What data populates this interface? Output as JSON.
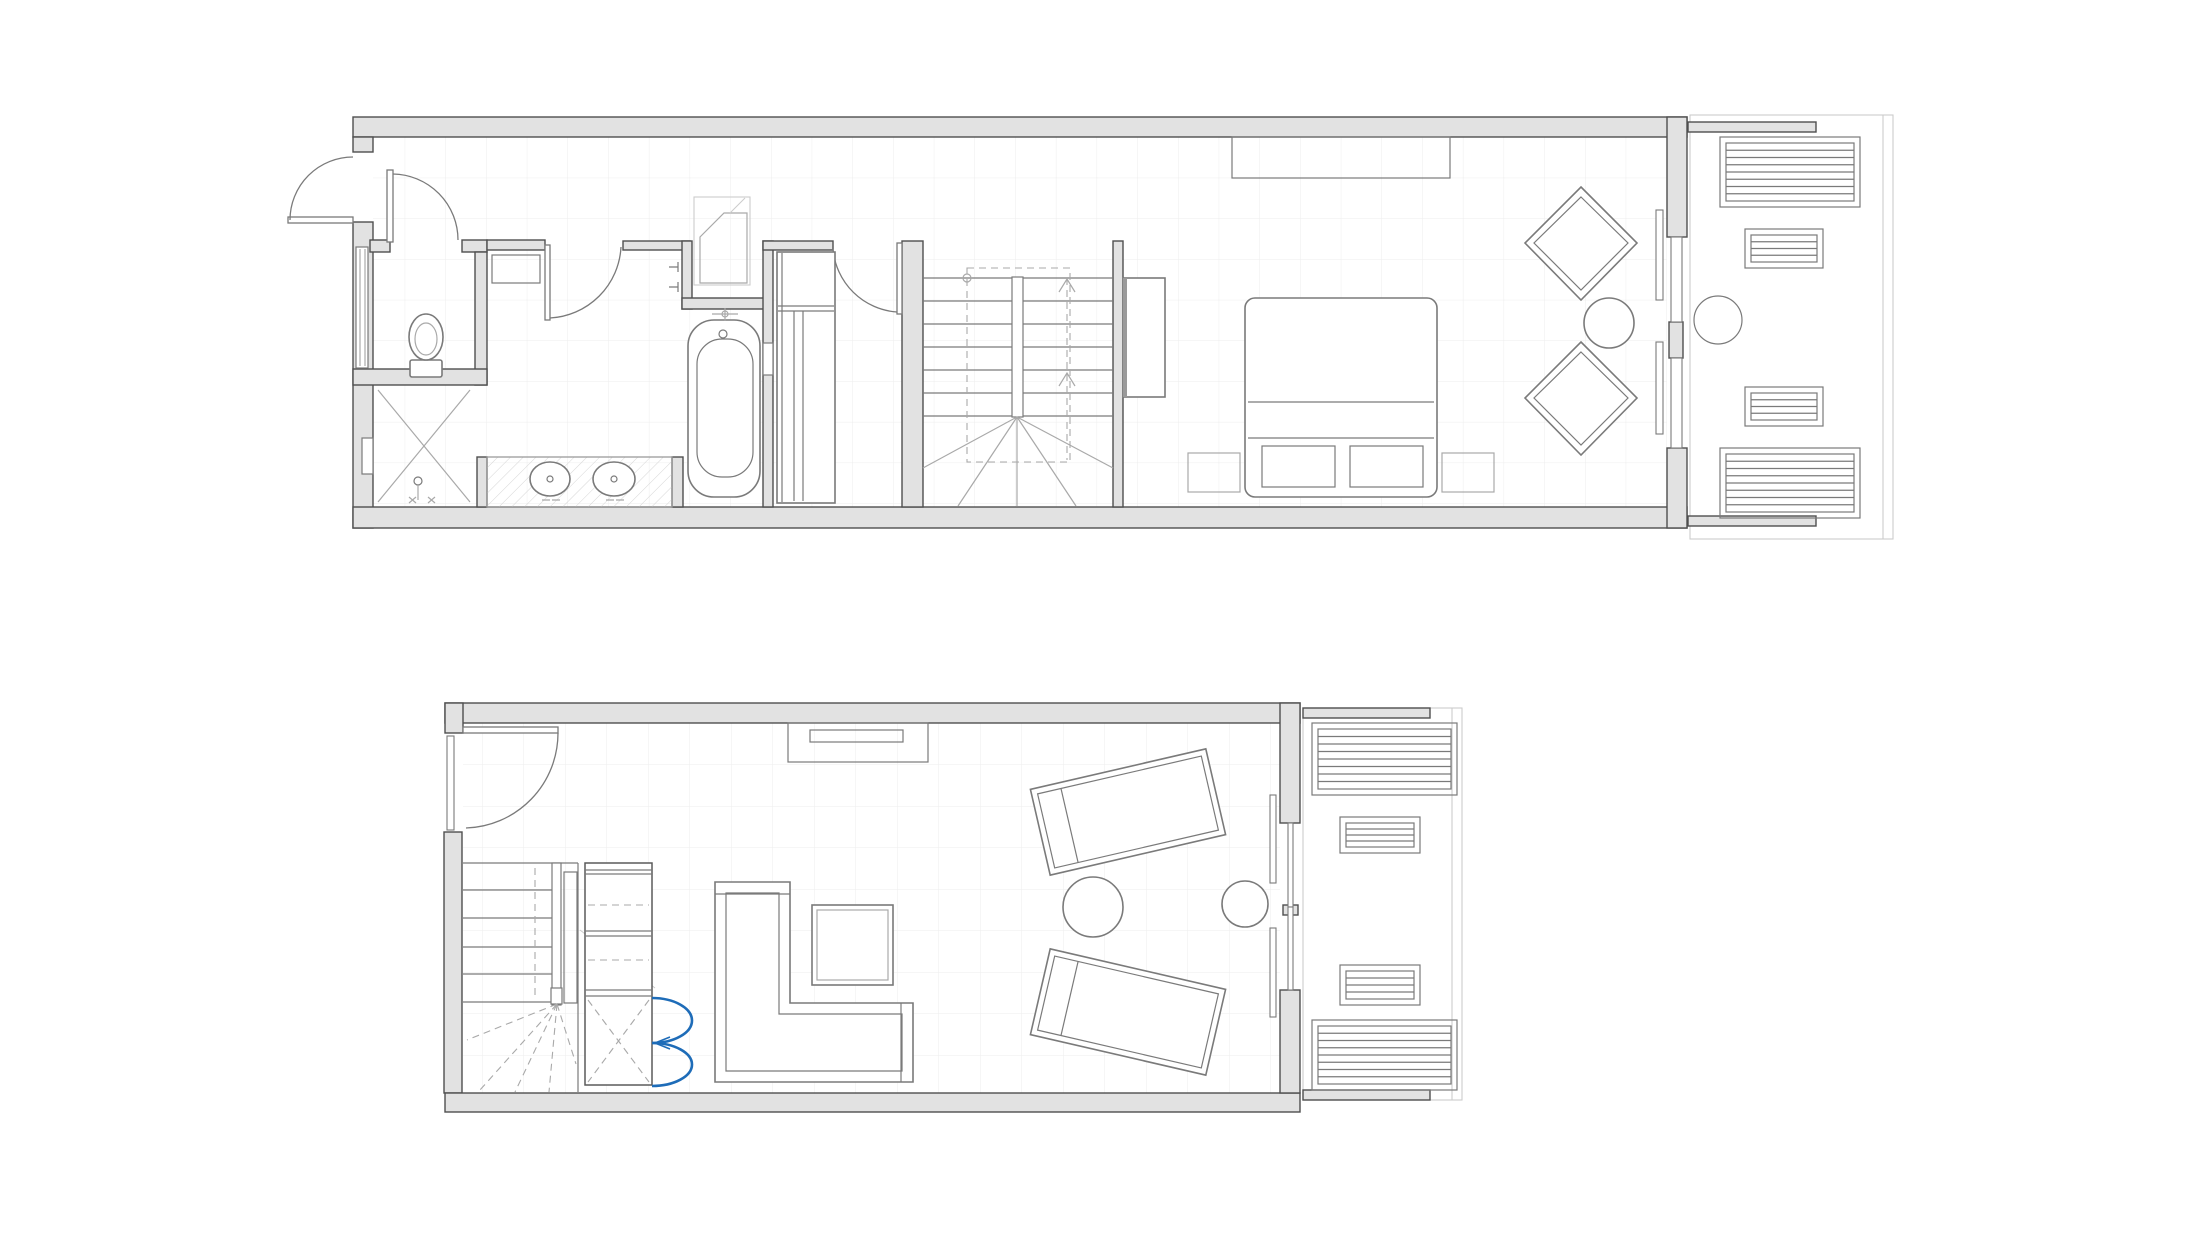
{
  "document": {
    "kind": "architectural-floor-plan",
    "description": "Two-level duplex apartment floor plan drawing, no text labels, line drawing on white background with light grid, gray walls and one blue highlighted double closet door",
    "canvas": {
      "width": 2200,
      "height": 1238,
      "background": "#ffffff"
    }
  },
  "colors": {
    "paper": "#ffffff",
    "wall_fill": "#e2e2e2",
    "wall_stroke": "#4f4f4f",
    "line_mid": "#7a7a7a",
    "line_lite": "#a9a9a9",
    "line_faint": "#cccccc",
    "grid": "#ededed",
    "accent_blue": "#1e6cb8"
  },
  "plans": [
    {
      "id": "upper-level",
      "name": "Upper level plan",
      "rooms": [
        "entry-hall",
        "wc",
        "shower-room",
        "bathroom",
        "stair-hall",
        "bedroom",
        "terrace"
      ],
      "fixtures": [
        "entry-door",
        "toilet",
        "shower-with-drain",
        "double-sink-vanity",
        "bathtub-with-taps",
        "linen-cabinet",
        "corner-niche-basin",
        "u-shaped-staircase",
        "wardrobe",
        "built-in-closet",
        "double-bed-with-drawer-bench",
        "two-nightstands",
        "two-diamond-lounge-chairs",
        "round-side-table",
        "sliding-glass-doors"
      ],
      "terrace_furniture": [
        "sun-lounger",
        "slat-ottoman",
        "round-patio-table",
        "slat-ottoman",
        "sun-lounger"
      ]
    },
    {
      "id": "lower-level",
      "name": "Lower level plan",
      "rooms": [
        "landing",
        "staircase",
        "closet",
        "living-room",
        "terrace"
      ],
      "fixtures": [
        "interior-door",
        "u-shaped-staircase",
        "shelved-closet-with-blue-double-doors",
        "tv-console-niche",
        "l-shaped-sofa",
        "square-coffee-table",
        "two-angled-chaises",
        "round-pouf",
        "round-side-table",
        "sliding-glass-doors"
      ],
      "terrace_furniture": [
        "sun-lounger",
        "slat-ottoman",
        "slat-ottoman",
        "sun-lounger"
      ]
    }
  ],
  "legend": {
    "wall_symbol": "gray filled bars",
    "door_symbol": "quarter-circle swing arcs",
    "stair_symbol": "treads with dashed walk line and up arrows",
    "highlight": "blue double swing doors on lower-level closet"
  }
}
